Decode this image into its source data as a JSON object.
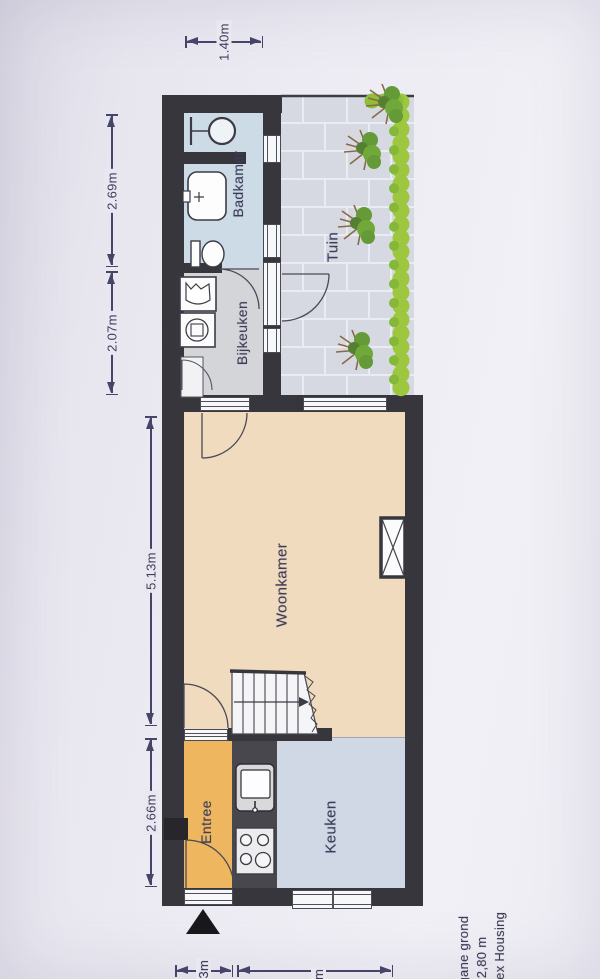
{
  "rooms": {
    "badkamer": "Badkamer",
    "bijkeuken": "Bijkeuken",
    "tuin": "Tuin",
    "woonkamer": "Woonkamer",
    "entree": "Entree",
    "keuken": "Keuken"
  },
  "dimensions": {
    "back_width": "1.40m",
    "badkamer_length": "2.69m",
    "bijkeuken_length": "2.07m",
    "woonkamer_length": "5.13m",
    "entree_length": "2.66m",
    "front_left": ".93m",
    "front_right": "70m"
  },
  "footer": {
    "floor_name": "egane grond",
    "ceiling_height": "= 2,80 m",
    "company": "Alex Housing"
  },
  "icons": {
    "north-arrow-icon": "solid black triangle pointing up",
    "shower-icon": "circle with spray arm",
    "washbasin-icon": "rounded basin with tap",
    "toilet-icon": "bowl with cistern",
    "laundry-sink-icon": "square basin",
    "washing-machine-icon": "square with drum circle",
    "kitchen-sink-icon": "counter sink with tap",
    "stove-icon": "four burner hob",
    "chimney-icon": "crossed box on wall",
    "stairs-icon": "treads with walk line arrow"
  },
  "colors": {
    "wall": "#36363c",
    "badkamer_floor": "#cddbe7",
    "bijkeuken_floor": "#d4d5d8",
    "woonkamer_floor": "#f0dbbe",
    "entree_floor": "#eeb65f",
    "keuken_floor": "#cfd8e4",
    "counter": "#47474d",
    "tuin_paving": "#d6d9e1",
    "hedge_green": "#9dc73f",
    "annotation_text": "#3e3e5e",
    "paper": "#eceaf2"
  }
}
